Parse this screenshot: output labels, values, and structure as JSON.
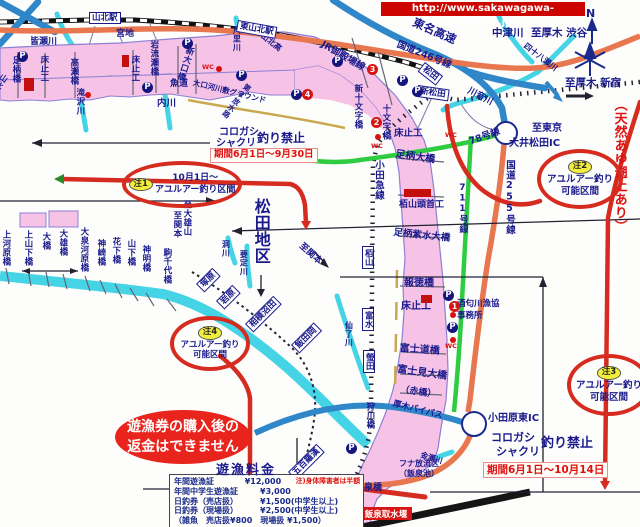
{
  "banner": {
    "url_label": "http://www.sakawagawa-gyokyou.jp/"
  },
  "colors": {
    "river_pink": "#f6c2e6",
    "river_outline": "#8f7fd4",
    "river_cyan": "#45d4e6",
    "expressway_blue": "#2f86c8",
    "route_orange": "#e8764e",
    "road_green": "#2ecc40",
    "regulation_red": "#d62c20",
    "label_navy": "#1a1a8c",
    "warn_red": "#e01010",
    "banner_bg": "#cc0500",
    "note_yellow": "#f2ee3c"
  },
  "compass": {
    "label": "N"
  },
  "fee_table": {
    "title": "遊漁料金",
    "rows": [
      [
        "年間遊漁証",
        "¥12,000",
        "注)身体障害者は半額"
      ],
      [
        "年間中学生遊漁証",
        "¥3,000",
        ""
      ],
      [
        "日釣券（売店扱）",
        "¥1,500(中学生以上)",
        ""
      ],
      [
        "日釣券（現場扱）",
        "¥2,500(中学生以上)",
        ""
      ],
      [
        "（雑魚　売店扱¥800　現場扱 ¥1,500）",
        "",
        ""
      ]
    ]
  },
  "periods": [
    {
      "text": "期間6月1日～9月30日",
      "x": 210,
      "y": 148,
      "s": 9.5
    },
    {
      "text": "期間6月1日～10月14日",
      "x": 483,
      "y": 462,
      "s": 10.5
    }
  ],
  "ellipses": [
    {
      "name": "note-1",
      "x": 122,
      "y": 161,
      "w": 112,
      "h": 39,
      "pill": "注1",
      "layout": "side",
      "lines": [
        "10月1日～",
        "アユルアー釣り区間"
      ],
      "ls": 9
    },
    {
      "name": "note-2",
      "x": 537,
      "y": 149,
      "w": 78,
      "h": 52,
      "pill": "注2",
      "lines": [
        "アユルアー釣り",
        "可能区間"
      ],
      "ls": 9.5
    },
    {
      "name": "note-3",
      "x": 567,
      "y": 354,
      "w": 76,
      "h": 54,
      "pill": "注3",
      "lines": [
        "アユルアー釣り",
        "可能区間"
      ],
      "ls": 9.5
    },
    {
      "name": "note-4",
      "x": 170,
      "y": 316,
      "w": 72,
      "h": 47,
      "pill": "注4",
      "lines": [
        "アユルアー釣り",
        "可能区間"
      ],
      "ls": 8.5
    },
    {
      "name": "refund-notice",
      "x": 115,
      "y": 410,
      "w": 136,
      "h": 54,
      "filled": true,
      "lines": [
        "遊漁券の購入後の",
        "返金はできません"
      ],
      "ls": 14
    }
  ],
  "stations": [
    {
      "name": "山北駅",
      "x": 89,
      "y": 12,
      "rot": 0
    },
    {
      "name": "東山北駅",
      "x": 238,
      "y": 20,
      "rot": 10
    },
    {
      "name": "松田",
      "x": 425,
      "y": 62,
      "rot": 38
    },
    {
      "name": "新松田",
      "x": 418,
      "y": 85,
      "rot": 8
    },
    {
      "name": "栢山",
      "x": 362,
      "y": 246,
      "vert": true
    },
    {
      "name": "富水",
      "x": 362,
      "y": 308,
      "vert": true
    },
    {
      "name": "螢田",
      "x": 363,
      "y": 350,
      "vert": true
    },
    {
      "name": "塚原",
      "x": 196,
      "y": 284,
      "rot": -45
    },
    {
      "name": "岩原",
      "x": 216,
      "y": 301,
      "rot": -45
    },
    {
      "name": "相模沼田",
      "x": 245,
      "y": 324,
      "rot": -45
    },
    {
      "name": "飯田岡",
      "x": 291,
      "y": 345,
      "rot": -45
    },
    {
      "name": "五百羅漢",
      "x": 288,
      "y": 472,
      "rot": -45
    }
  ],
  "markers": {
    "p_label": "P",
    "wc_label": "WC",
    "p": [
      [
        17,
        51
      ],
      [
        182,
        38
      ],
      [
        142,
        82
      ],
      [
        236,
        70
      ],
      [
        291,
        89
      ],
      [
        332,
        56
      ],
      [
        397,
        75
      ],
      [
        412,
        86
      ],
      [
        443,
        290
      ],
      [
        447,
        322
      ],
      [
        346,
        443
      ]
    ],
    "numbered": [
      {
        "n": "1",
        "x": 449,
        "y": 301
      },
      {
        "n": "2",
        "x": 371,
        "y": 117
      },
      {
        "n": "3",
        "x": 367,
        "y": 64
      },
      {
        "n": "4",
        "x": 302,
        "y": 89
      }
    ],
    "wc": [
      [
        202,
        63
      ],
      [
        445,
        131
      ],
      [
        371,
        142
      ],
      [
        445,
        342
      ]
    ],
    "dots": [
      [
        216,
        66
      ],
      [
        85,
        92
      ],
      [
        450,
        312
      ],
      [
        450,
        337
      ],
      [
        375,
        134
      ]
    ],
    "weir_rects": [
      {
        "x": 24,
        "y": 78,
        "w": 10,
        "h": 13
      },
      {
        "x": 122,
        "y": 55,
        "w": 7,
        "h": 12
      },
      {
        "x": 404,
        "y": 189,
        "w": 27,
        "h": 8
      },
      {
        "x": 421,
        "y": 295,
        "w": 11,
        "h": 8
      }
    ]
  },
  "labels": [
    {
      "t": "皆瀬川",
      "x": 30,
      "y": 38,
      "s": 9
    },
    {
      "t": "宮地",
      "x": 116,
      "y": 30,
      "s": 9
    },
    {
      "t": "魚道",
      "x": 170,
      "y": 80,
      "s": 9
    },
    {
      "t": "内川",
      "x": 157,
      "y": 99,
      "s": 9.5
    },
    {
      "t": "大口河川敷グラウンド",
      "x": 194,
      "y": 79,
      "s": 7.5,
      "r": 14
    },
    {
      "t": "山北高",
      "x": 264,
      "y": 32,
      "s": 8,
      "r": 38
    },
    {
      "t": "JR御殿場線",
      "x": 324,
      "y": 40,
      "s": 9.5,
      "r": 30
    },
    {
      "t": "国道246号線",
      "x": 399,
      "y": 40,
      "s": 9.5,
      "r": 22
    },
    {
      "t": "東名高速",
      "x": 416,
      "y": 16,
      "s": 11.5,
      "r": 24
    },
    {
      "t": "中津川",
      "x": 492,
      "y": 28,
      "s": 10.5
    },
    {
      "t": "至厚木 渋谷",
      "x": 531,
      "y": 28,
      "s": 10.5
    },
    {
      "t": "至厚木 新宿",
      "x": 565,
      "y": 78,
      "s": 10.5
    },
    {
      "t": "N",
      "x": 586,
      "y": 8,
      "s": 11
    },
    {
      "t": "川音川",
      "x": 470,
      "y": 87,
      "s": 9,
      "r": 28
    },
    {
      "t": "四十八瀬川",
      "x": 527,
      "y": 42,
      "s": 8,
      "r": 38
    },
    {
      "t": "コロガシ",
      "x": 219,
      "y": 128,
      "s": 10
    },
    {
      "t": "シャクリ",
      "x": 216,
      "y": 139,
      "s": 10
    },
    {
      "t": "釣り禁止",
      "x": 257,
      "y": 132,
      "s": 12
    },
    {
      "t": "床止工",
      "x": 394,
      "y": 129,
      "s": 9.5
    },
    {
      "t": "足柄大橋",
      "x": 396,
      "y": 150,
      "s": 10,
      "r": 8
    },
    {
      "t": "78号線",
      "x": 468,
      "y": 138,
      "s": 9.5,
      "r": -20
    },
    {
      "t": "至東京",
      "x": 532,
      "y": 124,
      "s": 10
    },
    {
      "t": "大井松田IC",
      "x": 509,
      "y": 139,
      "s": 10
    },
    {
      "t": "栢山頭首工",
      "x": 399,
      "y": 201,
      "s": 9
    },
    {
      "t": "足柄紫水大橋",
      "x": 394,
      "y": 228,
      "s": 9.5,
      "r": 6
    },
    {
      "t": "報徳橋",
      "x": 404,
      "y": 279,
      "s": 10
    },
    {
      "t": "床止工",
      "x": 401,
      "y": 302,
      "s": 10
    },
    {
      "t": "酒匂川漁協",
      "x": 457,
      "y": 300,
      "s": 8.5
    },
    {
      "t": "事務所",
      "x": 457,
      "y": 312,
      "s": 8.5
    },
    {
      "t": "富士道橋",
      "x": 400,
      "y": 344,
      "s": 10,
      "r": 4
    },
    {
      "t": "富士見大橋",
      "x": 398,
      "y": 365,
      "s": 10,
      "r": 8
    },
    {
      "t": "（赤橋）",
      "x": 401,
      "y": 386,
      "s": 9,
      "r": 8
    },
    {
      "t": "コロガシ",
      "x": 491,
      "y": 432,
      "s": 11
    },
    {
      "t": "シャクリ",
      "x": 496,
      "y": 446,
      "s": 11
    },
    {
      "t": "釣り禁止",
      "x": 541,
      "y": 437,
      "s": 13
    },
    {
      "t": "小田原東IC",
      "x": 488,
      "y": 414,
      "s": 10
    },
    {
      "t": "フナ放流区",
      "x": 399,
      "y": 460,
      "s": 8
    },
    {
      "t": "（飯泉池）",
      "x": 399,
      "y": 470,
      "s": 8
    },
    {
      "t": "飯泉橋",
      "x": 355,
      "y": 484,
      "s": 9
    },
    {
      "t": "金瀬川",
      "x": 422,
      "y": 451,
      "s": 7.5,
      "r": 18
    },
    {
      "t": "至小田原",
      "x": 248,
      "y": 490,
      "s": 9,
      "r": 50
    },
    {
      "t": "至小田原",
      "x": 301,
      "y": 503,
      "s": 9,
      "r": 50
    },
    {
      "t": "至関本",
      "x": 303,
      "y": 242,
      "s": 9,
      "r": 42
    },
    {
      "t": "厚木バイパス",
      "x": 394,
      "y": 400,
      "s": 8.5,
      "r": 14
    },
    {
      "t": "足柄橋",
      "x": 11,
      "y": 56,
      "s": 8.5,
      "v": 1
    },
    {
      "t": "床止工",
      "x": 39,
      "y": 55,
      "s": 8.5,
      "v": 1
    },
    {
      "t": "高瀬橋",
      "x": 69,
      "y": 58,
      "s": 8.5,
      "v": 1
    },
    {
      "t": "滝沢川",
      "x": 75,
      "y": 88,
      "s": 8.5,
      "v": 1
    },
    {
      "t": "床止工",
      "x": 130,
      "y": 55,
      "s": 8.5,
      "v": 1
    },
    {
      "t": "岩流瀬橋",
      "x": 149,
      "y": 40,
      "s": 8.5,
      "v": 1
    },
    {
      "t": "新大口橋",
      "x": 186,
      "y": 45,
      "s": 8.5,
      "v": 1,
      "r": 18
    },
    {
      "t": "尺里川",
      "x": 232,
      "y": 26,
      "s": 8,
      "v": 1
    },
    {
      "t": "第2放水路",
      "x": 246,
      "y": 82,
      "s": 7.5,
      "v": 1,
      "r": 38
    },
    {
      "t": "新十文字橋",
      "x": 353,
      "y": 84,
      "s": 8.5,
      "v": 1
    },
    {
      "t": "十文字橋",
      "x": 381,
      "y": 104,
      "s": 8.5,
      "v": 1
    },
    {
      "t": "小田急線",
      "x": 373,
      "y": 160,
      "s": 9.5,
      "v": 1
    },
    {
      "t": "国道255号線",
      "x": 504,
      "y": 160,
      "s": 9.5,
      "v": 1
    },
    {
      "t": "711号線",
      "x": 457,
      "y": 183,
      "s": 9,
      "v": 1
    },
    {
      "t": "（天然あゆ遡上あり）",
      "x": 612,
      "y": 98,
      "s": 13,
      "v": 1,
      "c": "red"
    },
    {
      "t": "松田地区",
      "x": 252,
      "y": 198,
      "s": 16,
      "v": 1
    },
    {
      "t": "至大雄山",
      "x": 182,
      "y": 200,
      "s": 8.5,
      "v": 1
    },
    {
      "t": "至関本",
      "x": 172,
      "y": 211,
      "s": 8.5,
      "v": 1
    },
    {
      "t": "上河原橋",
      "x": 1,
      "y": 230,
      "s": 8.5,
      "v": 1
    },
    {
      "t": "上山下橋",
      "x": 23,
      "y": 230,
      "s": 8.5,
      "v": 1
    },
    {
      "t": "大橋",
      "x": 41,
      "y": 232,
      "s": 8.5,
      "v": 1
    },
    {
      "t": "大雄橋",
      "x": 58,
      "y": 229,
      "s": 8.5,
      "v": 1
    },
    {
      "t": "大泉河原橋",
      "x": 79,
      "y": 227,
      "s": 8.5,
      "v": 1
    },
    {
      "t": "神崎橋",
      "x": 96,
      "y": 239,
      "s": 8.5,
      "v": 1
    },
    {
      "t": "花下橋",
      "x": 111,
      "y": 237,
      "s": 8.5,
      "v": 1
    },
    {
      "t": "山下橋",
      "x": 126,
      "y": 239,
      "s": 8.5,
      "v": 1
    },
    {
      "t": "神明橋",
      "x": 141,
      "y": 245,
      "s": 8.5,
      "v": 1
    },
    {
      "t": "駒千代橋",
      "x": 162,
      "y": 248,
      "s": 8.5,
      "v": 1
    },
    {
      "t": "洞川",
      "x": 221,
      "y": 240,
      "s": 8,
      "v": 1
    },
    {
      "t": "要定川",
      "x": 239,
      "y": 250,
      "s": 8,
      "v": 1
    },
    {
      "t": "仙了川",
      "x": 344,
      "y": 321,
      "s": 8,
      "v": 1
    },
    {
      "t": "狩川橋",
      "x": 365,
      "y": 402,
      "s": 8.5,
      "v": 1
    },
    {
      "t": "山北バイパス",
      "x": 2,
      "y": 72,
      "s": 8,
      "v": 1,
      "r": 35
    }
  ]
}
